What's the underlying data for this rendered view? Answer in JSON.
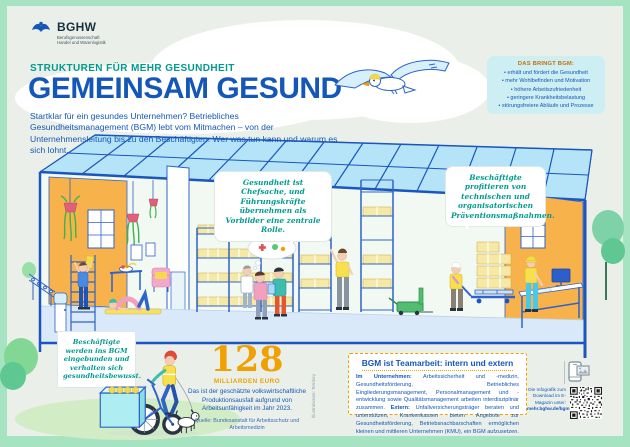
{
  "colors": {
    "brand_blue": "#1557b8",
    "teal": "#009b8e",
    "orange": "#f0a000",
    "mint_frame": "#a5e3c1",
    "panel_bg": "#eaf0e9",
    "info_box_bg": "#cdeef3",
    "wall_orange": "#f8b24b",
    "roof_blue": "#b5e4f8"
  },
  "logo": {
    "name": "BGHW",
    "line1": "Berufsgenossenschaft",
    "line2": "Handel und Warenlogistik"
  },
  "header": {
    "kicker": "STRUKTUREN FÜR MEHR GESUNDHEIT",
    "title": "GEMEINSAM GESUND",
    "intro": "Startklar für ein gesundes Unternehmen? Betriebliches Gesundheitsmanagement (BGM) lebt vom Mitmachen – von der Unternehmensleitung bis zu den Beschäftigten. Wer was tun kann und warum es sich lohnt."
  },
  "benefits": {
    "title": "DAS BRINGT BGM:",
    "items": [
      "erhält und fördert die Gesundheit",
      "mehr Wohlbefinden und Motivation",
      "höhere Arbeitszufriedenheit",
      "geringere Krankheitsbelastung",
      "störungsfreiere Abläufe und Prozesse"
    ]
  },
  "bubbles": {
    "leadership": "Gesundheit ist Chefsache, und Führungskräfte übernehmen als Vorbilder eine zentrale Rolle.",
    "prevention": "Beschäftigte profitieren von technischen und organisatorischen Präventionsmaßnahmen.",
    "participation": "Beschäftigte werden ins BGM eingebunden und verhalten sich gesundheitsbewusst."
  },
  "stat": {
    "number": "128",
    "unit": "MILLIARDEN EURO",
    "description": "Das ist der geschätzte volkswirtschaftliche Produktionsausfall aufgrund von Arbeitsunfähigkeit im Jahr 2023.",
    "source": "Quelle: Bundesanstalt für Arbeitsschutz und Arbeitsmedizin"
  },
  "teamwork": {
    "title": "BGM ist Teamarbeit: intern und extern",
    "intern_label": "Im Unternehmen: ",
    "intern_text": "Arbeitssicherheit und -medizin, Gesundheitsförderung, Betriebliches Eingliederungsmanagement, Personalmanagement und -entwicklung sowie Qualitätsmanagement arbeiten interdisziplinär zusammen. ",
    "extern_label": "Extern: ",
    "extern_text": "Unfallversicherungsträger beraten und unterstützen, Krankenkassen bieten Angebote zur Gesundheitsförderung, Betriebsnachbarschaften ermöglichen kleinen und mittleren Unternehmen (KMU), ein BGM aufzusetzen."
  },
  "download": {
    "text": "Die Infografik zum Download im E-Magazin unter: ",
    "link": "mehr.bghw.de/bgm"
  },
  "credit": "Illustrationen: Territory"
}
